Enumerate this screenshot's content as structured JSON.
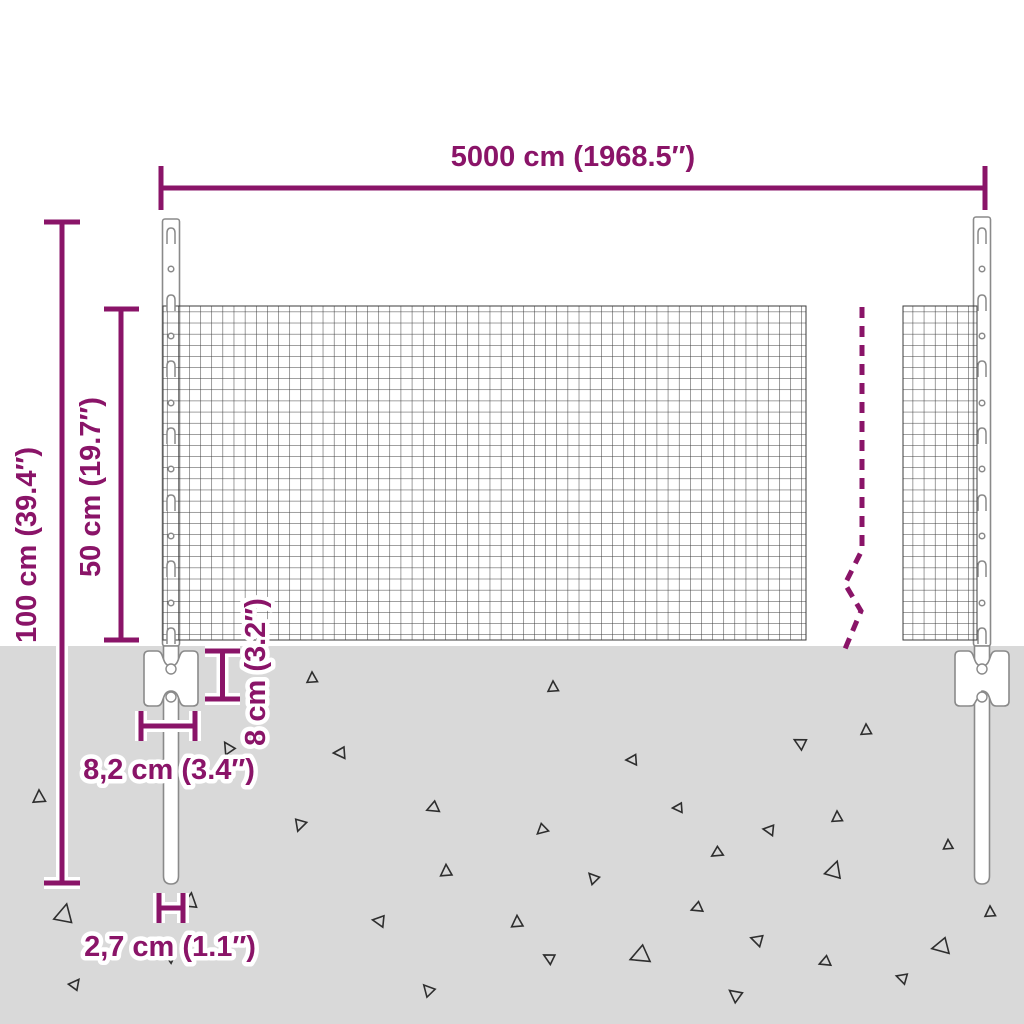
{
  "diagram": {
    "title": "wire-mesh-fence-dimension-diagram",
    "labels": {
      "total_length": "5000 cm (1968.5″)",
      "post_height": "100 cm (39.4″)",
      "mesh_height": "50 cm (19.7″)",
      "anchor_plate_height": "8 cm (3.2″)",
      "anchor_plate_width": "8,2 cm (3.4″)",
      "post_diameter": "2,7 cm (1.1″)"
    },
    "colors": {
      "dimension": "#8A1468",
      "ground": "#D9D9D9",
      "mesh_line": "#3B3B3B",
      "part_outline": "#8A8A8A"
    },
    "ground_triangles": [
      [
        39,
        797,
        13,
        0
      ],
      [
        64,
        914,
        19,
        15
      ],
      [
        75,
        984,
        11,
        40
      ],
      [
        170,
        958,
        9,
        300
      ],
      [
        190,
        901,
        15,
        10
      ],
      [
        228,
        748,
        12,
        330
      ],
      [
        300,
        825,
        12,
        200
      ],
      [
        312,
        678,
        11,
        0
      ],
      [
        340,
        753,
        12,
        270
      ],
      [
        379,
        921,
        12,
        280
      ],
      [
        428,
        990,
        12,
        320
      ],
      [
        433,
        808,
        12,
        250
      ],
      [
        446,
        871,
        12,
        0
      ],
      [
        517,
        922,
        12,
        0
      ],
      [
        542,
        830,
        11,
        230
      ],
      [
        549,
        958,
        11,
        300
      ],
      [
        553,
        687,
        11,
        0
      ],
      [
        593,
        878,
        11,
        320
      ],
      [
        632,
        760,
        11,
        270
      ],
      [
        640,
        956,
        19,
        250
      ],
      [
        678,
        808,
        10,
        270
      ],
      [
        697,
        908,
        11,
        250
      ],
      [
        717,
        853,
        11,
        240
      ],
      [
        735,
        995,
        13,
        310
      ],
      [
        757,
        940,
        12,
        290
      ],
      [
        769,
        830,
        11,
        280
      ],
      [
        800,
        743,
        12,
        300
      ],
      [
        825,
        962,
        11,
        250
      ],
      [
        834,
        870,
        17,
        20
      ],
      [
        837,
        817,
        11,
        0
      ],
      [
        866,
        730,
        11,
        0
      ],
      [
        902,
        978,
        11,
        290
      ],
      [
        941,
        947,
        17,
        260
      ],
      [
        948,
        845,
        10,
        0
      ],
      [
        990,
        912,
        11,
        0
      ]
    ]
  }
}
